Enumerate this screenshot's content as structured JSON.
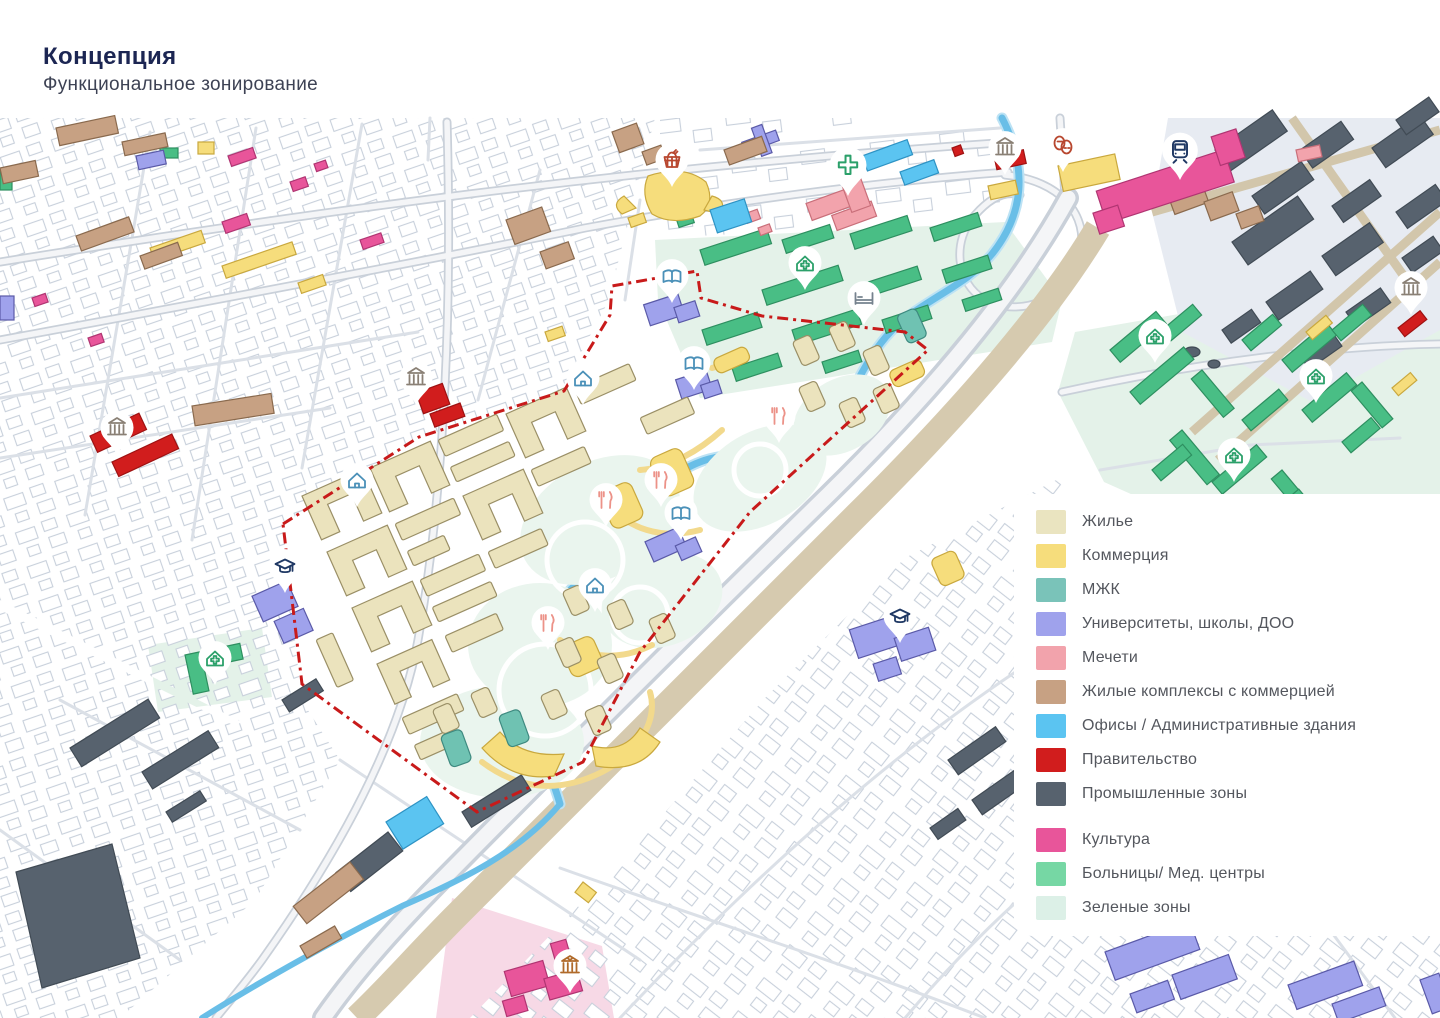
{
  "header": {
    "title": "Концепция",
    "subtitle": "Функциональное зонирование"
  },
  "legend": {
    "items": [
      {
        "label": "Жилье",
        "color": "#EAE4C0"
      },
      {
        "label": "Коммерция",
        "color": "#F6DD7C"
      },
      {
        "label": "МЖК",
        "color": "#7AC3B9"
      },
      {
        "label": "Университеты, школы, ДОО",
        "color": "#9FA2EC"
      },
      {
        "label": "Мечети",
        "color": "#F2A3AC"
      },
      {
        "label": "Жилые комплексы с коммерцией",
        "color": "#C7A183"
      },
      {
        "label": "Офисы / Административные здания",
        "color": "#5BC4F1"
      },
      {
        "label": "Правительство",
        "color": "#D11D1D"
      },
      {
        "label": "Промышленные зоны",
        "color": "#57626E"
      },
      {
        "label": "Культура",
        "color": "#E8559A"
      },
      {
        "label": "Больницы/ Мед. центры",
        "color": "#76D7A4"
      },
      {
        "label": "Зеленые зоны",
        "color": "#DCF0E7"
      }
    ]
  },
  "map": {
    "boundary_color": "#C81A1A",
    "river_color": "#69BEE7",
    "railway_color": "#D6CAAF",
    "markers": [
      {
        "icon": "market-basket-icon"
      },
      {
        "icon": "medical-cross-icon"
      },
      {
        "icon": "bank-icon"
      },
      {
        "icon": "bank-icon"
      },
      {
        "icon": "bank-icon"
      },
      {
        "icon": "bank-icon"
      },
      {
        "icon": "theater-masks-icon"
      },
      {
        "icon": "train-icon"
      },
      {
        "icon": "book-icon"
      },
      {
        "icon": "book-icon"
      },
      {
        "icon": "book-icon"
      },
      {
        "icon": "home-icon"
      },
      {
        "icon": "home-icon"
      },
      {
        "icon": "home-icon"
      },
      {
        "icon": "clinic-home-icon"
      },
      {
        "icon": "clinic-home-icon"
      },
      {
        "icon": "clinic-home-icon"
      },
      {
        "icon": "clinic-home-icon"
      },
      {
        "icon": "clinic-home-icon"
      },
      {
        "icon": "graduation-cap-icon"
      },
      {
        "icon": "graduation-cap-icon"
      },
      {
        "icon": "hotel-bed-icon"
      },
      {
        "icon": "restaurant-icon"
      },
      {
        "icon": "restaurant-icon"
      },
      {
        "icon": "restaurant-icon"
      },
      {
        "icon": "restaurant-icon"
      },
      {
        "icon": "museum-icon"
      }
    ]
  }
}
